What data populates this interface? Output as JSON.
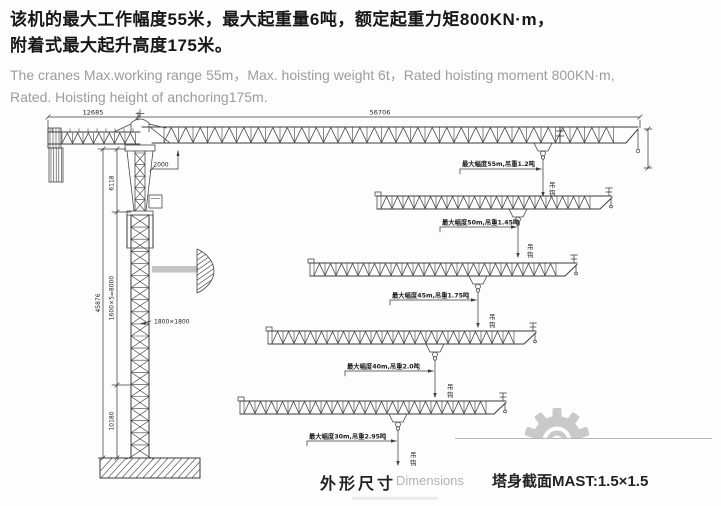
{
  "header": {
    "cn_line1": "该机的最大工作幅度55米，最大起重量6吨，额定起重力矩800KN·m，",
    "cn_line2": "附着式最大起升高度175米。",
    "en_line1": "The cranes Max.working range 55m，Max. hoisting weight 6t，Rated hoisting moment 800KN·m,",
    "en_line2": "Rated. Hoisting height of anchoring175m."
  },
  "drawing": {
    "dims": {
      "counter_jib_length": "12685",
      "jib_length": "56706",
      "head_clearance": "2000",
      "head_section_height": "6118",
      "mast_sections": "1600×5=8000",
      "base_section_height": "10180",
      "total_height": "45876",
      "mast_cross_section": "1800×1800"
    },
    "config_labels": [
      "最大幅度55m,吊重1.2吨",
      "最大幅度50m,吊重1.45吨",
      "最大幅度45m,吊重1.75吨",
      "最大幅度40m,吊重2.0吨",
      "最大幅度30m,吊重2.95吨"
    ],
    "hook_marker_top": "吊",
    "hook_marker_bottom": "钩"
  },
  "footer": {
    "caption_cn": "外形尺寸",
    "caption_en": "Dimensions",
    "mast_spec": "塔身截面MAST:1.5×1.5"
  },
  "colors": {
    "line": "#3c3c3c",
    "heading": "#171717",
    "subtext": "#9c9c9c",
    "watermark": "#c9c9c9"
  }
}
